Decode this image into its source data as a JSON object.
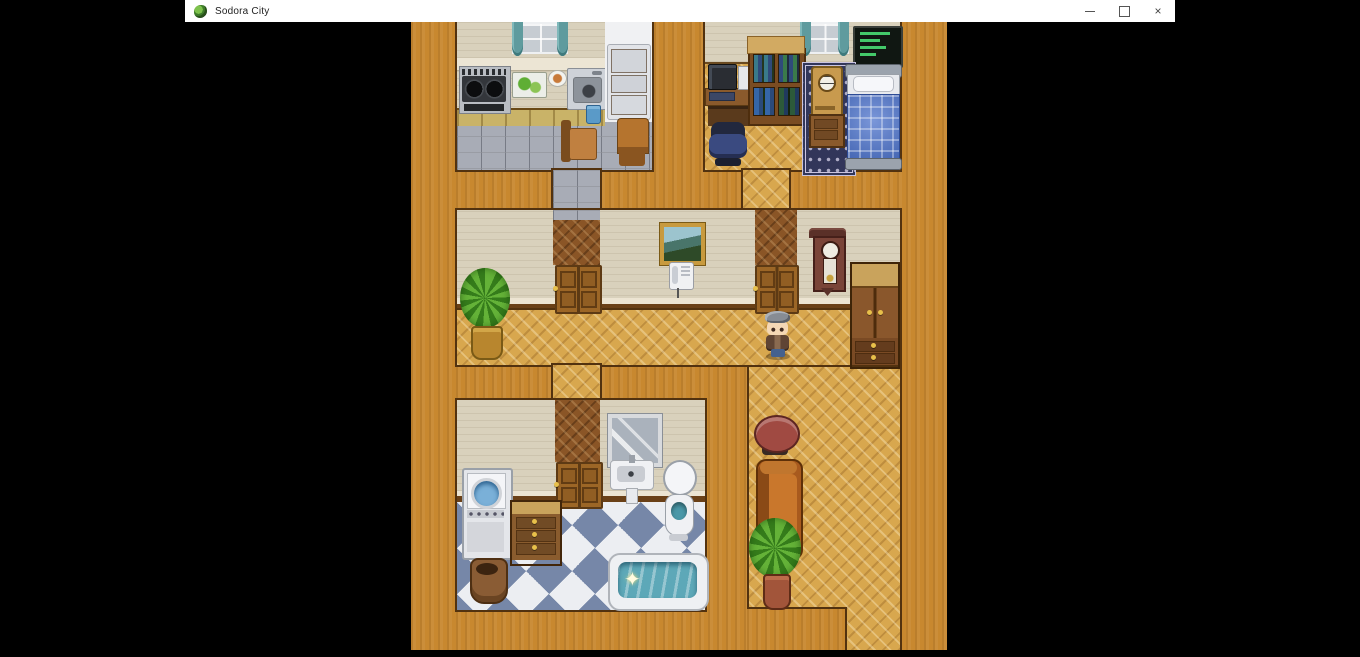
{
  "window": {
    "title": "Sodora City",
    "icon": "dragon-game-icon",
    "controls": {
      "minimize": "–",
      "maximize": "",
      "close": "×"
    }
  },
  "game": {
    "scene": "house-interior-top-down-map",
    "style": "RPG Maker style 2D tile map",
    "rooms": [
      "kitchen",
      "bedroom",
      "phone-hallway-room",
      "plant-room",
      "bathroom-laundry",
      "living-hallway"
    ],
    "character": {
      "description": "gray-haired chibi player character facing down",
      "location": "hallway below door, center-right of map"
    },
    "effects": {
      "bath_sparkle": "✦"
    },
    "furniture": [
      "stove",
      "cutting-board",
      "plate",
      "kitchen-sink",
      "refrigerator",
      "chairs",
      "computer-desk",
      "office-chair",
      "bookshelf",
      "terminal-screen",
      "mantel-clock",
      "nightstand",
      "rug",
      "bed",
      "framed-picture",
      "telephone",
      "potted-plant",
      "grandfather-clock",
      "wardrobe",
      "washing-machine",
      "dresser",
      "clay-pot",
      "mirror",
      "bathroom-sink",
      "toilet",
      "bathtub",
      "round-table",
      "couch"
    ],
    "colors": {
      "hall_floor": "#d8a74e",
      "wall_top": "#c8882f",
      "room_wall": "#d9d1bc",
      "kitchen_tile": "#a8acb6",
      "bath_checker_blue": "#7687a8",
      "bath_checker_white": "#eceef2",
      "bed_quilt": "#4e74cc",
      "couch": "#b5641f",
      "terminal_text": "#43c96a",
      "curtains": "#5f9b9e"
    }
  }
}
